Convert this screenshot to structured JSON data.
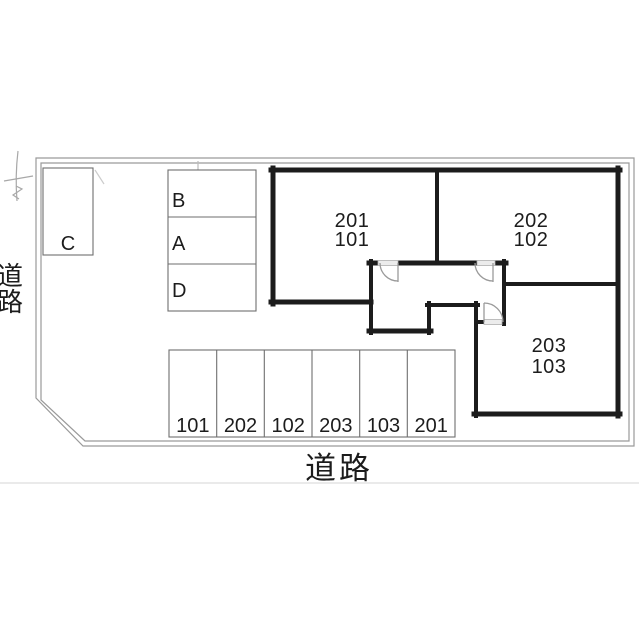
{
  "plan": {
    "title": "site-and-parking-plan",
    "roads": {
      "left": "道路",
      "bottom": "道路"
    },
    "units": [
      {
        "upper": "201",
        "lower": "101"
      },
      {
        "upper": "202",
        "lower": "102"
      },
      {
        "upper": "203",
        "lower": "103"
      }
    ],
    "spaces": {
      "c": "C",
      "column": [
        "B",
        "A",
        "D"
      ]
    },
    "stalls": [
      "101",
      "202",
      "102",
      "203",
      "103",
      "201"
    ],
    "colors": {
      "wall": "#1c1c1c",
      "boundary": "#9a9a9a",
      "thin_line": "#6e6e6e",
      "door": "#9a9a9a",
      "sill_fill": "#ececec",
      "sill_edge": "#b0b0b0",
      "text": "#1c1c1c",
      "sketch": "#a8a8a8",
      "seam": "#e3e3e3"
    }
  }
}
